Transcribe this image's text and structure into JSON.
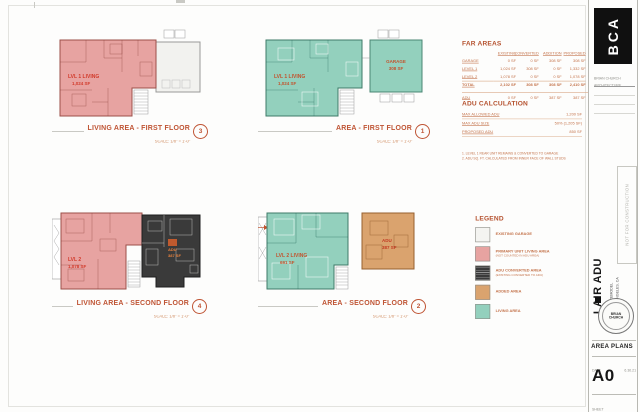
{
  "sheet": {
    "accent": "#bf5434",
    "line": "#c9c9c4",
    "bg": "#ffffff"
  },
  "plans": [
    {
      "title": "LIVING AREA - FIRST FLOOR",
      "scale": "SCALE:  1/8\" = 1'-0\"",
      "bubble": "3",
      "labels": {
        "main_1": "LVL 1 LIVING",
        "main_2": "1,024 SF"
      }
    },
    {
      "title": "AREA - FIRST FLOOR",
      "scale": "SCALE:  1/8\" = 1'-0\"",
      "bubble": "1",
      "labels": {
        "main_1": "LVL 1 LIVING",
        "main_2": "1,024 SF",
        "garage_1": "GARAGE",
        "garage_2": "308 SF"
      }
    },
    {
      "title": "LIVING AREA - SECOND FLOOR",
      "scale": "SCALE:  1/8\" = 1'-0\"",
      "bubble": "4",
      "labels": {
        "main_1": "LVL 2",
        "main_2": "1,078 SF",
        "adu_1": "ADU",
        "adu_2": "387 SF"
      }
    },
    {
      "title": "AREA - SECOND FLOOR",
      "scale": "SCALE:  1/8\" = 1'-0\"",
      "bubble": "2",
      "labels": {
        "main_1": "LVL 2 LIVING",
        "main_2": "691 SF",
        "adu_1": "ADU",
        "adu_2": "387 SF"
      }
    }
  ],
  "far_table": {
    "title": "FAR AREAS",
    "columns": [
      "EXISTING",
      "CONVERTED",
      "ADDITION",
      "PROPOSED"
    ],
    "rows": [
      {
        "label": "GARAGE",
        "values": [
          "0 SF",
          "0 SF",
          "308 SF",
          "308 SF"
        ]
      },
      {
        "label": "LEVEL 1",
        "values": [
          "1,024 SF",
          "308 SF",
          "0 SF",
          "1,332 SF"
        ]
      },
      {
        "label": "LEVEL 2",
        "values": [
          "1,078 SF",
          "0 SF",
          "0 SF",
          "1,078 SF"
        ]
      },
      {
        "label": "TOTAL",
        "values": [
          "2,102 SF",
          "308 SF",
          "308 SF",
          "2,410 SF"
        ]
      },
      {
        "label": "ADU",
        "values": [
          "0 SF",
          "0 SF",
          "387 SF",
          "387 SF"
        ]
      }
    ]
  },
  "adu_calc": {
    "title": "ADU CALCULATION",
    "rows": [
      {
        "label": "MAX ALLOWED ADU",
        "value": "1,200 SF"
      },
      {
        "label": "MAX ADU SIZE",
        "value": "50% (1,205 SF)"
      },
      {
        "label": "PROPOSED ADU",
        "value": "850 SF"
      }
    ],
    "notes": [
      "1. LEVEL 1 REAR UNIT REMAINS & CONVERTED TO GARAGE",
      "2. ADU SQ. FT. CALCULATED FROM INNER FACE OF WALL STUDS"
    ]
  },
  "legend": {
    "title": "LEGEND",
    "items": [
      {
        "label": "EXISTING GARAGE",
        "sub": "",
        "color": "#f4f4f1"
      },
      {
        "label": "PRIMARY UNIT LIVING AREA",
        "sub": "(NOT COUNTED IN ADU AREA)",
        "color": "#e7a3a1"
      },
      {
        "label": "ADU CONVERTED AREA",
        "sub": "(EXISTING CONVERTED TO ADU)",
        "color": "#3a3a3a"
      },
      {
        "label": "ADDED AREA",
        "sub": "",
        "color": "#daa36e"
      },
      {
        "label": "LIVING AREA",
        "sub": "",
        "color": "#93d0bd"
      }
    ]
  },
  "titleblock": {
    "logo_text": "BCA",
    "firm_line1": "BRIAN CHURCH",
    "firm_line2": "ARCHITECTURE",
    "not_for_construction": "NOT FOR CONSTRUCTION",
    "project_name": "LAIR ADU",
    "project_line1": "ADU REMODEL",
    "project_line2": "LOS ANGELES, CA",
    "stamp_line1": "BRIAN",
    "stamp_line2": "CHURCH",
    "sheet_title": "AREA PLANS",
    "date_label": "DATE",
    "date": "6.30.21",
    "sheet_label": "SHEET",
    "sheet_number": "A0"
  }
}
